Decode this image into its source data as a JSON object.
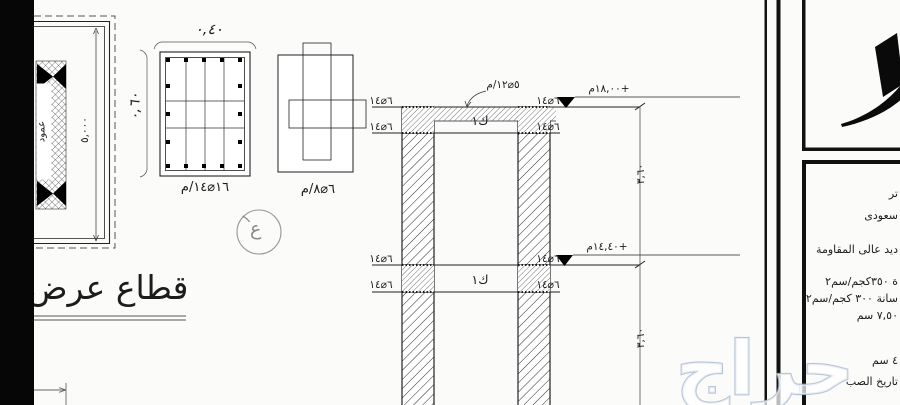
{
  "plan": {
    "span_dim": "٥,٠٠٠",
    "column_text": "عمود"
  },
  "detail_a": {
    "width_dim": "٠,٤٠",
    "height_dim": "٠,٦٠",
    "rebar_label": "١٦⌀١٤/م"
  },
  "detail_b": {
    "rebar_label": "٦⌀٨/م"
  },
  "bubble": {
    "number": "١",
    "letter": "ع"
  },
  "section_title": "قطاع عرض",
  "section": {
    "slab_rebar_label": "٥⌀١٢/م",
    "joint_rebar_label": "٦⌀١٤",
    "beam_label": "ك١",
    "level_upper": "+١٨,٠٠م",
    "level_lower": "+١٤,٤٠م",
    "floor_height_dim": "٣,٦٠"
  },
  "title_block": {
    "line_1": "تر",
    "line_2": "سعودى",
    "line_3": "ديد عالى المقاومة",
    "line_4": "ة ٣٥٠كجم/سم٢",
    "line_5": "سانة ٣٠٠ كجم/سم٢",
    "line_6": "٧,٥٠ سم",
    "line_7": "٤ سم",
    "line_8": "تاريخ الصب"
  },
  "watermark": {
    "text": "حراج"
  },
  "colors": {
    "ink": "#1c1c1c",
    "dim_line": "#555555",
    "bubble": "#8a8a8a",
    "watermark_stroke": "#a9bcd2",
    "paper": "#fbfbf9"
  }
}
